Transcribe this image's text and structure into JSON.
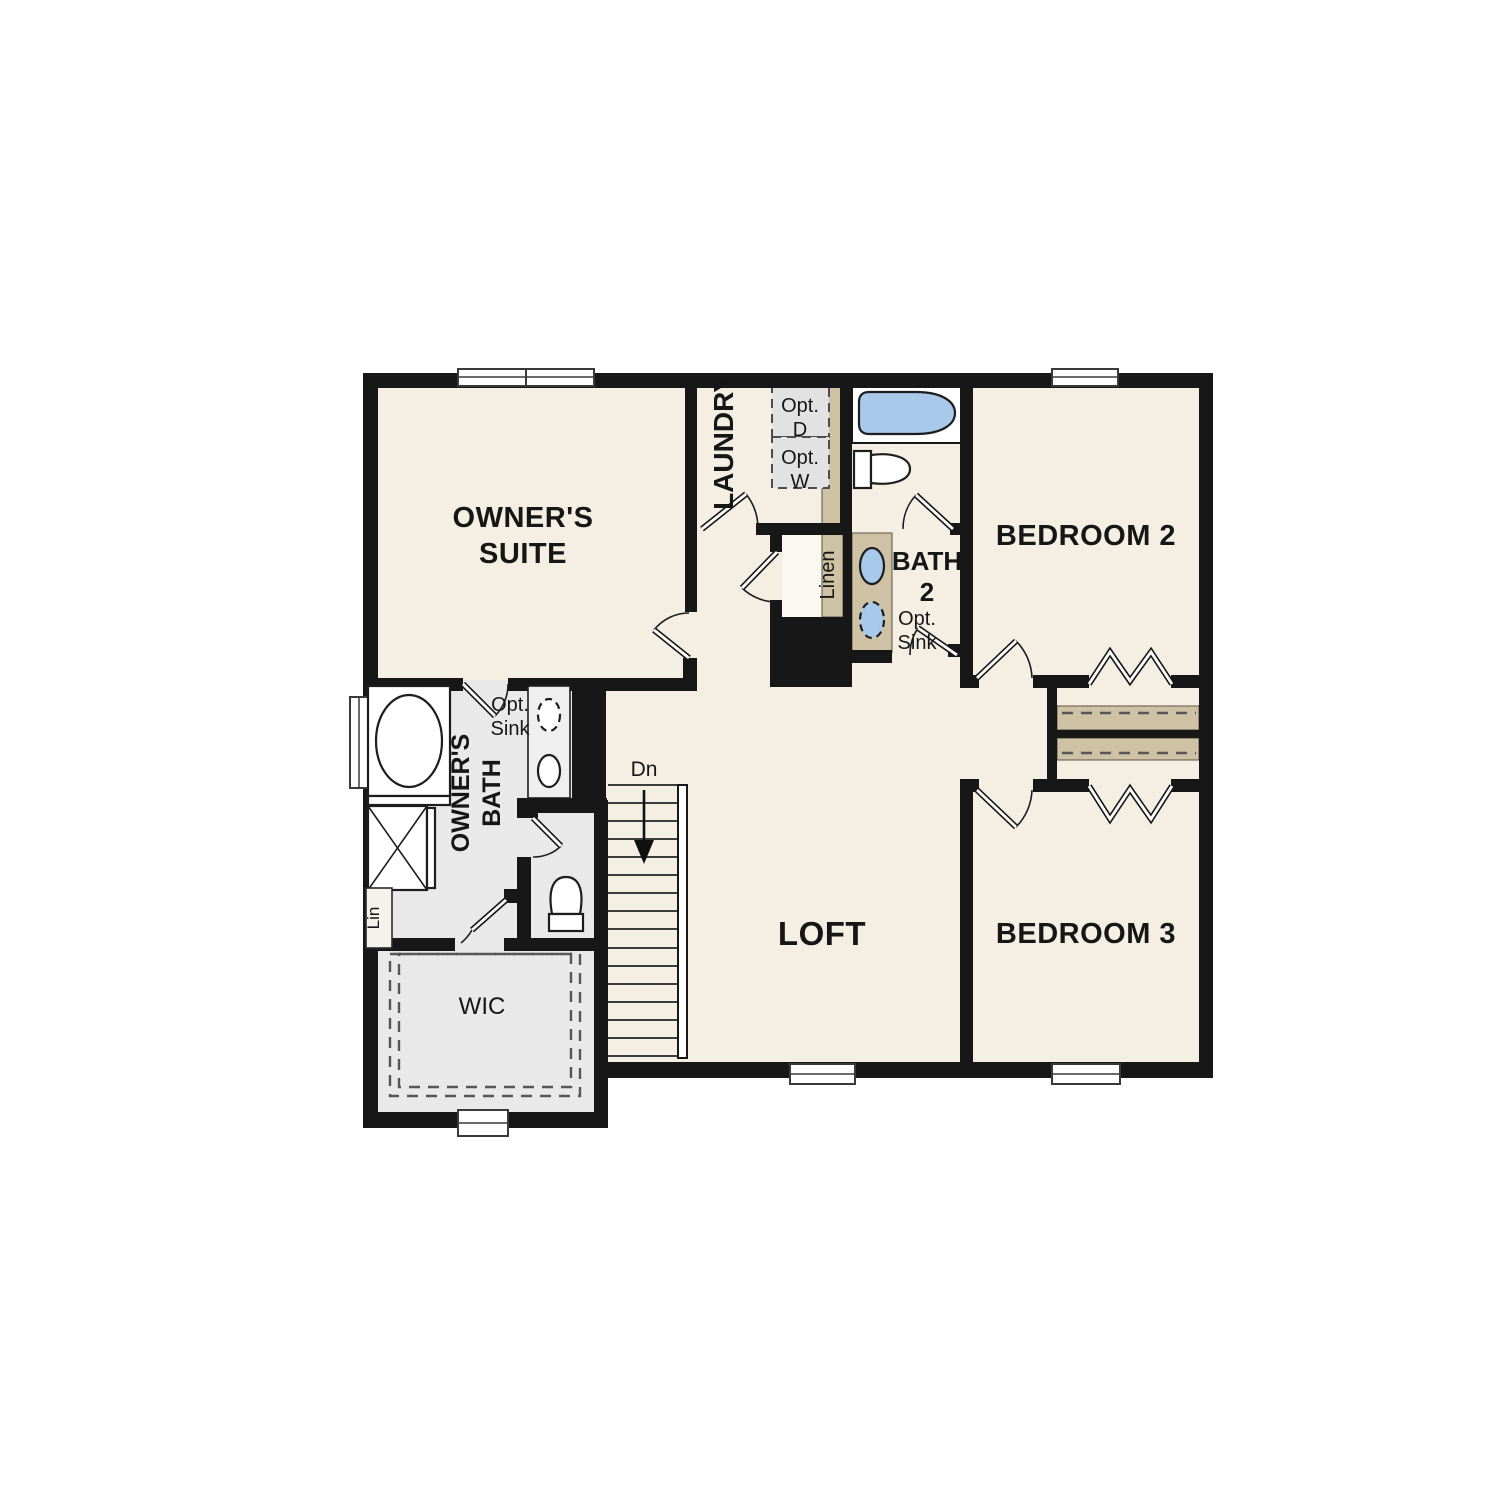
{
  "plan": {
    "type": "floor-plan",
    "floor": "second-floor",
    "rooms": {
      "owners_suite": {
        "line1": "OWNER'S",
        "line2": "SUITE"
      },
      "laundry": {
        "label": "LAUNDRY"
      },
      "bedroom2": {
        "label": "BEDROOM 2"
      },
      "bath2": {
        "line1": "BATH",
        "line2": "2"
      },
      "owners_bath": {
        "line1": "OWNER'S",
        "line2": "BATH"
      },
      "wic": {
        "label": "WIC"
      },
      "loft": {
        "label": "LOFT"
      },
      "bedroom3": {
        "label": "BEDROOM 3"
      }
    },
    "labels": {
      "opt_dryer": {
        "line1": "Opt.",
        "line2": "D"
      },
      "opt_washer": {
        "line1": "Opt.",
        "line2": "W"
      },
      "linen_closet": {
        "label": "Linen"
      },
      "lin_closet": {
        "label": "Lin"
      },
      "bath2_opt_sink": {
        "line1": "Opt.",
        "line2": "Sink"
      },
      "owners_opt_sink": {
        "line1": "Opt.",
        "line2": "Sink"
      },
      "stairs_down": {
        "label": "Dn"
      }
    },
    "colors": {
      "wall": "#171717",
      "floor_main": "#f5eee2",
      "floor_bath": "#e9e9e9",
      "closet_shelf": "#cfc1a4",
      "fixture_blue": "#a9c9ea",
      "optional_appliance": "#e2e2e2",
      "background": "#ffffff"
    },
    "fixtures": [
      "bath2-tub",
      "bath2-toilet",
      "bath2-double-sink-vanity",
      "owners-garden-tub",
      "owners-shower",
      "owners-double-sink-vanity",
      "owners-water-closet-toilet",
      "stairs-down",
      "washer-dryer-optional"
    ]
  }
}
